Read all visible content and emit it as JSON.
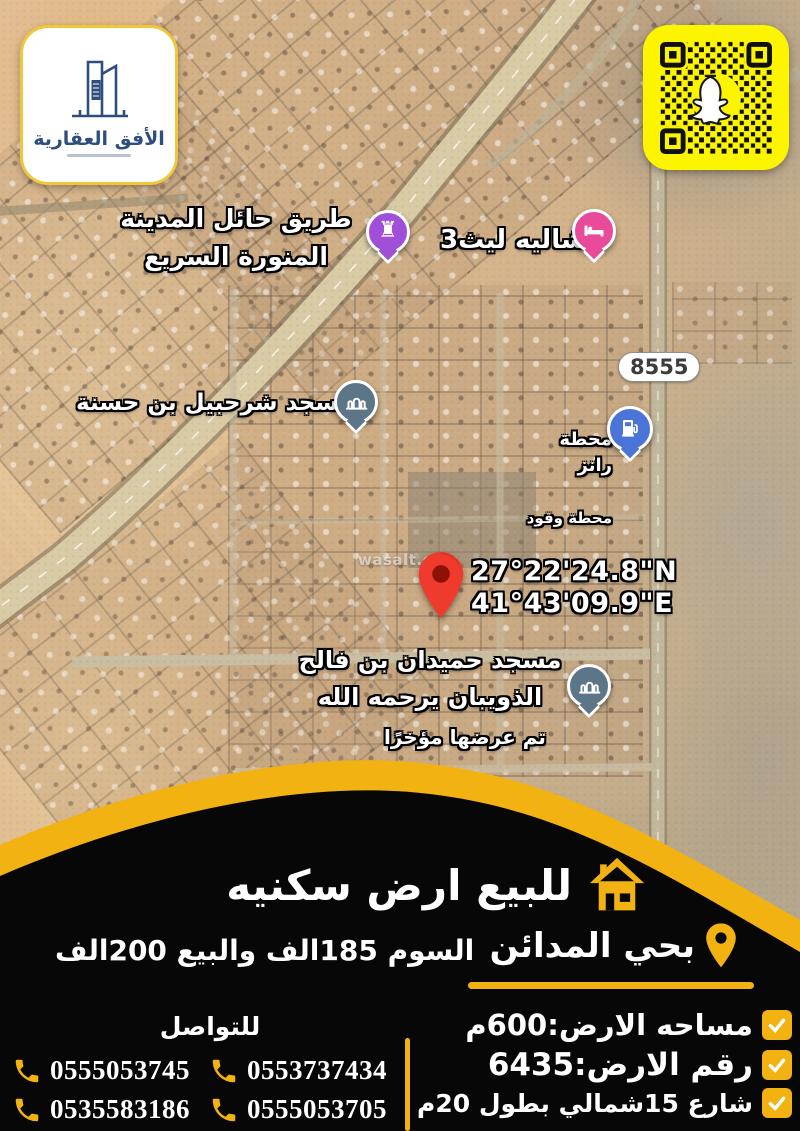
{
  "brand": {
    "logo_title": "الأفق العقارية",
    "logo_icon": "building-skyline",
    "qr_icon": "snapchat-qr-code"
  },
  "map": {
    "watermark": "wasalt.com",
    "route_badge": "8555",
    "labels": {
      "highway": "طريق حائل المدينة\nالمنورة السريع",
      "chalet": "شاليه ليث3",
      "mosque_sharhabil": "مسجد شرحبيل بن حسنة",
      "station_name": "محطة رانز",
      "station_type": "محطة وقود",
      "coords_lat": "27°22'24.8\"N",
      "coords_lng": "41°43'09.9\"E",
      "mosque_hamidan": "مسجد حميدان بن فالح\nالذويبان يرحمه الله",
      "recently_shown": "تم عرضها مؤخرًا"
    }
  },
  "listing": {
    "title": "للبيع ارض سكنيه",
    "neighborhood": "بحي المدائن",
    "price": "السوم 185الف والبيع 200الف",
    "details": [
      "مساحه الارض:600م",
      "رقم الارض:6435",
      "شارع 15شمالي بطول 20م"
    ],
    "contact_label": "للتواصل",
    "phones": [
      "0555053745",
      "0553737434",
      "0535583186",
      "0555053705"
    ]
  },
  "colors": {
    "accent_yellow": "#F2B211",
    "panel_black": "#0A0A0A",
    "snapchat_yellow": "#FDF500",
    "pin_red": "#EA4335",
    "pin_purple": "#A050D8",
    "pin_pink": "#EA4A9A",
    "pin_blue": "#4A74D8",
    "pin_slate": "#5C7587",
    "logo_blue": "#2E4E7E"
  }
}
